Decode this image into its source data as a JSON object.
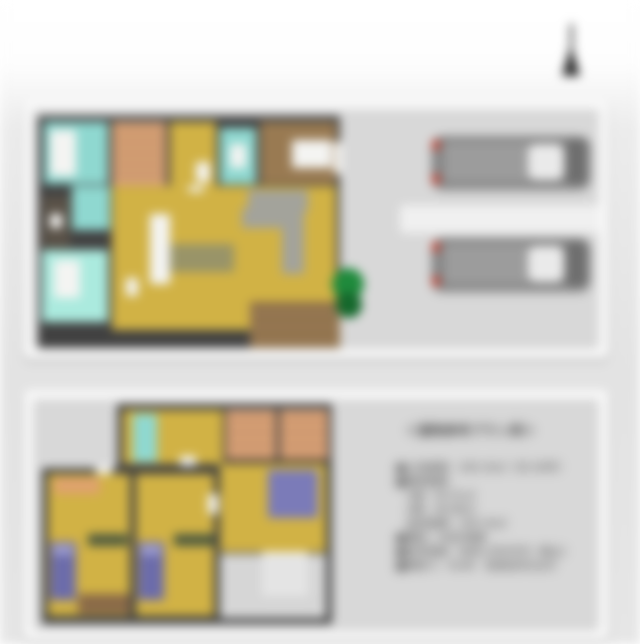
{
  "compass": {
    "icon": "north-arrow",
    "color": "#2b2b2b"
  },
  "plan_card": {
    "title": "＜建物参考プラン例＞",
    "specs": [
      "■土地面積：100.19㎡（30.30坪）",
      "■建物面積",
      "　1階：50.51㎡",
      "　2階：49.68㎡",
      "　延床面積：100.19㎡",
      "■構造：木造2階建",
      "■参考価格：本体1,650万円（税込）",
      "■間取り：4LDK　駐車並列2台可"
    ]
  },
  "floors": {
    "first": {
      "rooms": [
        "bathroom",
        "staircase",
        "hallway",
        "toilet",
        "entrance-hall",
        "corridor",
        "storage",
        "washroom",
        "ldk",
        "kitchen",
        "dining",
        "entrance-porch"
      ],
      "furniture": [
        "bathtub",
        "washing-machine",
        "kitchen-counter",
        "kitchen-island",
        "dining-rug",
        "sofa",
        "shoe-cabinet"
      ]
    },
    "second": {
      "rooms": [
        "hall",
        "bathroom",
        "closet",
        "closet",
        "bedroom-left",
        "bedroom-middle",
        "bedroom-right",
        "stairwell"
      ],
      "furniture": [
        "bed",
        "bed",
        "bed",
        "desk",
        "desk",
        "desk"
      ]
    }
  },
  "parking": {
    "spaces": 2,
    "vehicles": [
      "car",
      "car"
    ]
  },
  "palette": {
    "floor_yellow": "#d1b245",
    "bath_cyan": "#8fd8d0",
    "washroom_mint": "#abeade",
    "stairs_tan": "#dca87e",
    "entrance_brown": "#997a52",
    "porch_brown": "#8d6f4b",
    "sofa_gray": "#a3a39b",
    "rug_olive": "#999468",
    "bed_indigo": "#6c6caa",
    "bed_blue": "#7b7bb8",
    "car_gray": "#858585",
    "taillight_red": "#c04436",
    "tree_green": "#1f8a3c",
    "wall_dark": "#414141",
    "ground_gray": "#d8d8d8",
    "text_dark": "#3c3c3c"
  }
}
